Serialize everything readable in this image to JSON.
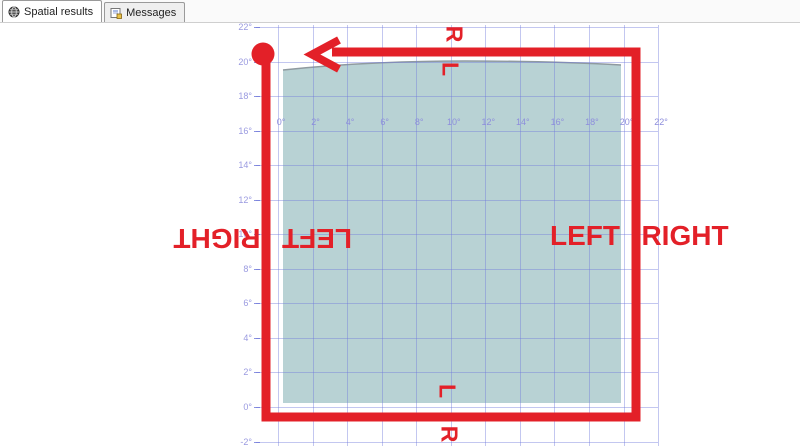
{
  "tabs": [
    {
      "label": "Spatial results",
      "icon": "globe-icon",
      "active": true
    },
    {
      "label": "Messages",
      "icon": "messages-icon",
      "active": false
    }
  ],
  "colors": {
    "annotation_red": "#e32028",
    "polygon_fill": "#b8d2d4",
    "polygon_edge": "#8f9aa0",
    "grid_line": "rgba(112,122,220,0.42)",
    "axis_label_blue": "#9a9ae0"
  },
  "chart_data": {
    "type": "area",
    "title": "Spatial results map grid",
    "x_tick_labels": [
      "0°",
      "2°",
      "4°",
      "6°",
      "8°",
      "10°",
      "12°",
      "14°",
      "16°",
      "18°",
      "20°",
      "22°"
    ],
    "y_tick_labels": [
      "22°",
      "20°",
      "18°",
      "16°",
      "14°",
      "12°",
      "10°",
      "8°",
      "6°",
      "4°",
      "2°",
      "0°",
      "-2°"
    ],
    "x_range_deg": [
      0,
      22
    ],
    "y_range_deg": [
      -2,
      22
    ],
    "grid": "on, light periwinkle lines every 2 degrees",
    "polygon_bounds_deg": {
      "x": [
        0.2,
        19.9
      ],
      "y": [
        0.6,
        20.4
      ]
    },
    "red_path_rect_deg": {
      "x": [
        -0.7,
        20.7
      ],
      "y": [
        -0.6,
        20.6
      ]
    },
    "red_path_description": "thick red rectangle route with start-point dot at top-left and left-pointing arrow on top edge"
  },
  "annotations": {
    "top": {
      "above_line": "R",
      "below_line": "L"
    },
    "bottom": {
      "above_line": "L",
      "below_line": "R"
    },
    "left_side": {
      "outside": "RIGHT",
      "inside": "LEFT"
    },
    "right_side": {
      "inside": "LEFT",
      "outside": "RIGHT"
    }
  }
}
